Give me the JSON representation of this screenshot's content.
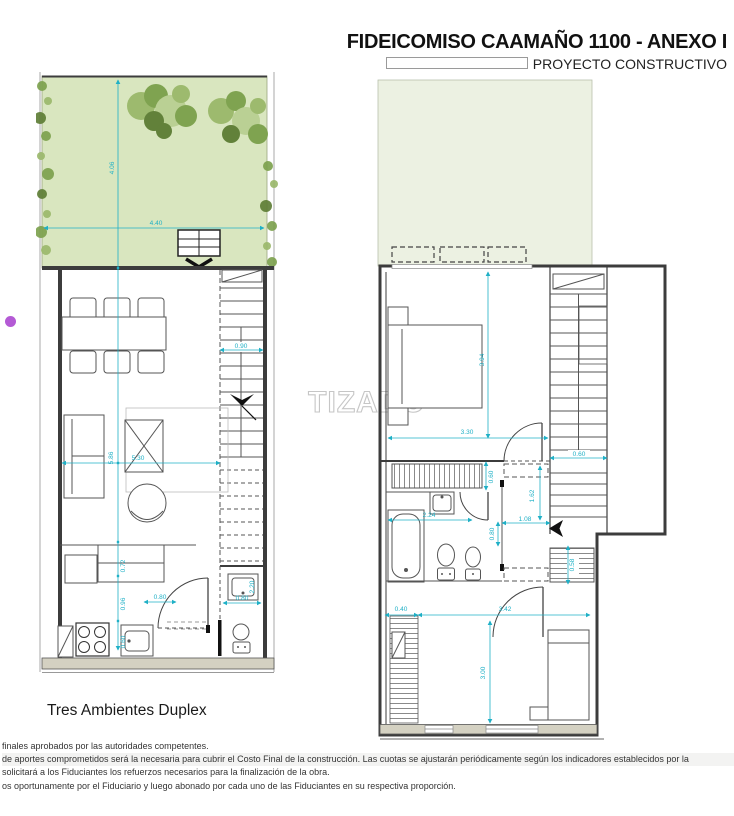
{
  "header": {
    "title": "FIDEICOMISO CAAMAÑO 1100 - ANEXO I",
    "subtitle": "PROYECTO CONSTRUCTIVO"
  },
  "watermark": "TIZADO",
  "caption": "Tres Ambientes Duplex",
  "colors": {
    "dimension": "#1fb0c6",
    "garden": "#d9e6bf",
    "terrace": "#ecf1e2",
    "band": "#d4d1c2",
    "wall": "#3c3c3c",
    "watermark": "#c6c6c6",
    "dot": "#b45ad5",
    "tree1": "#9ab86a",
    "tree2": "#7ba04b",
    "tree3": "#b9cf92",
    "tree4": "#5c7c33"
  },
  "left_plan": {
    "label": "ground-floor",
    "dims": {
      "garden_h": "4.06",
      "garden_w": "4.40",
      "stair_w": "0.90",
      "living_h": "5.86",
      "living_w": "5.30",
      "kitchen_top": "0.72",
      "kitchen_mid": "0.96",
      "kitchen_low": "0.60",
      "door_w": "0.80",
      "bath_h": "2.20",
      "bath_w": "0.80"
    }
  },
  "right_plan": {
    "label": "upper-floor",
    "dims": {
      "bed1_h": "3.94",
      "bed1_w": "3.30",
      "stair_w": "0.60",
      "closet_h": "0.60",
      "bath_w": "2.24",
      "hall_w": "1.08",
      "hall_h": "1.62",
      "bath_door": "0.80",
      "stair2_h": "0.58",
      "closet2_w": "0.40",
      "bed2_w": "3.42",
      "bed2_h": "3.00"
    }
  },
  "footnotes": [
    "finales aprobados por las autoridades competentes.",
    "de aportes comprometidos será la necesaria para cubrir el Costo Final de la construcción. Las cuotas se ajustarán periódicamente según los indicadores establecidos por la",
    "solicitará a los Fiduciantes los refuerzos necesarios para la finalización de la obra.",
    "os oportunamente por el Fiduciario y luego abonado por cada uno de las Fiduciantes en su respectiva proporción."
  ]
}
